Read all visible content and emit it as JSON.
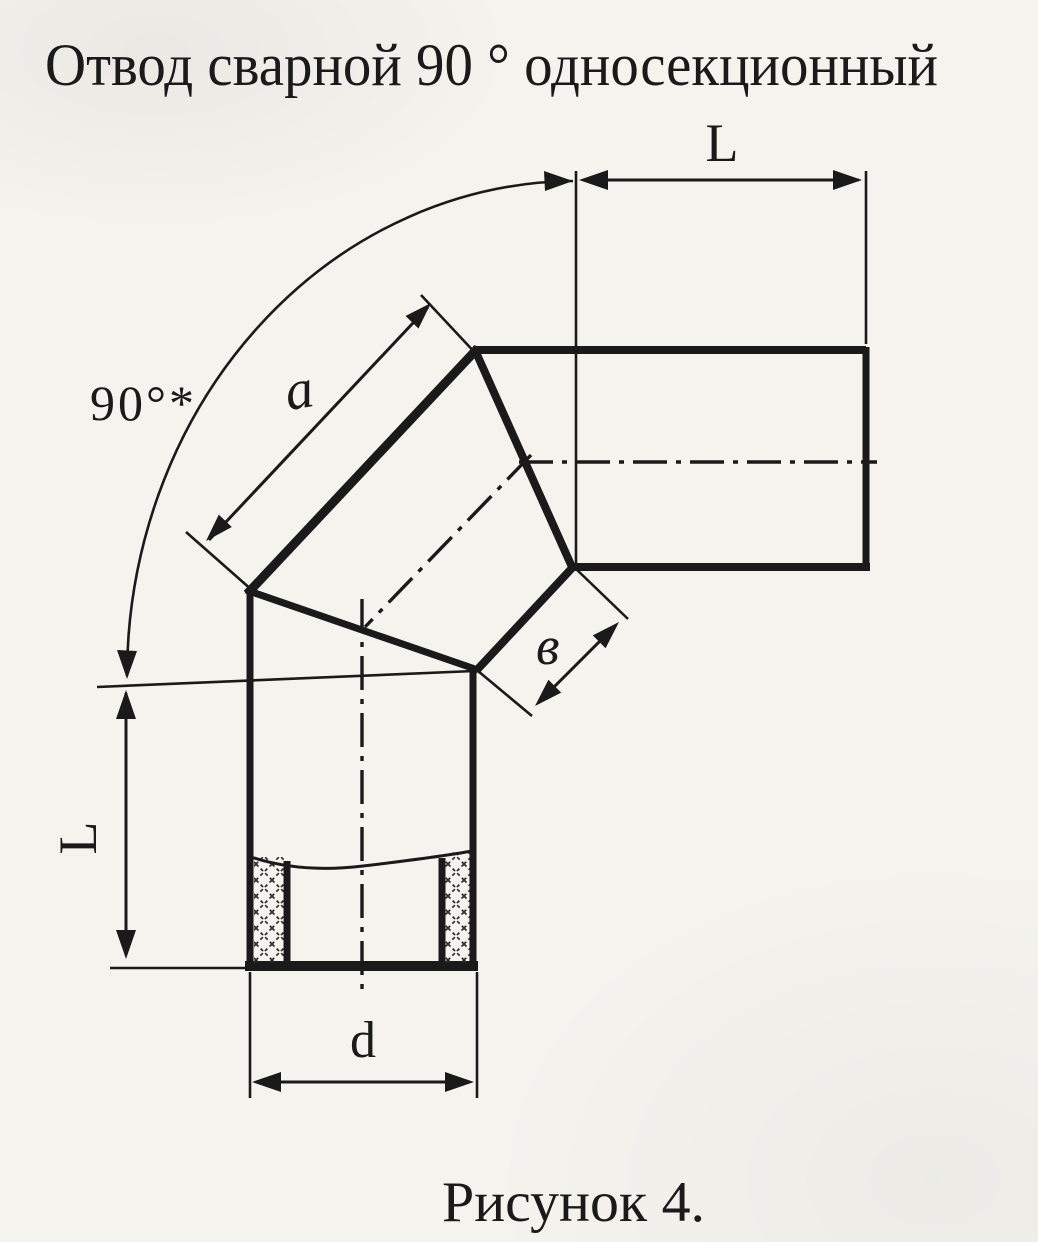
{
  "title": "Отвод сварной 90 ° односекционный",
  "caption": "Рисунок 4.",
  "labels": {
    "angle": "90°*",
    "length_top": "L",
    "length_left": "L",
    "segment_a": "a",
    "segment_b": "в",
    "diameter_d": "d"
  },
  "colors": {
    "ink": "#1a1a1a",
    "paper": "#f4f3ee"
  }
}
